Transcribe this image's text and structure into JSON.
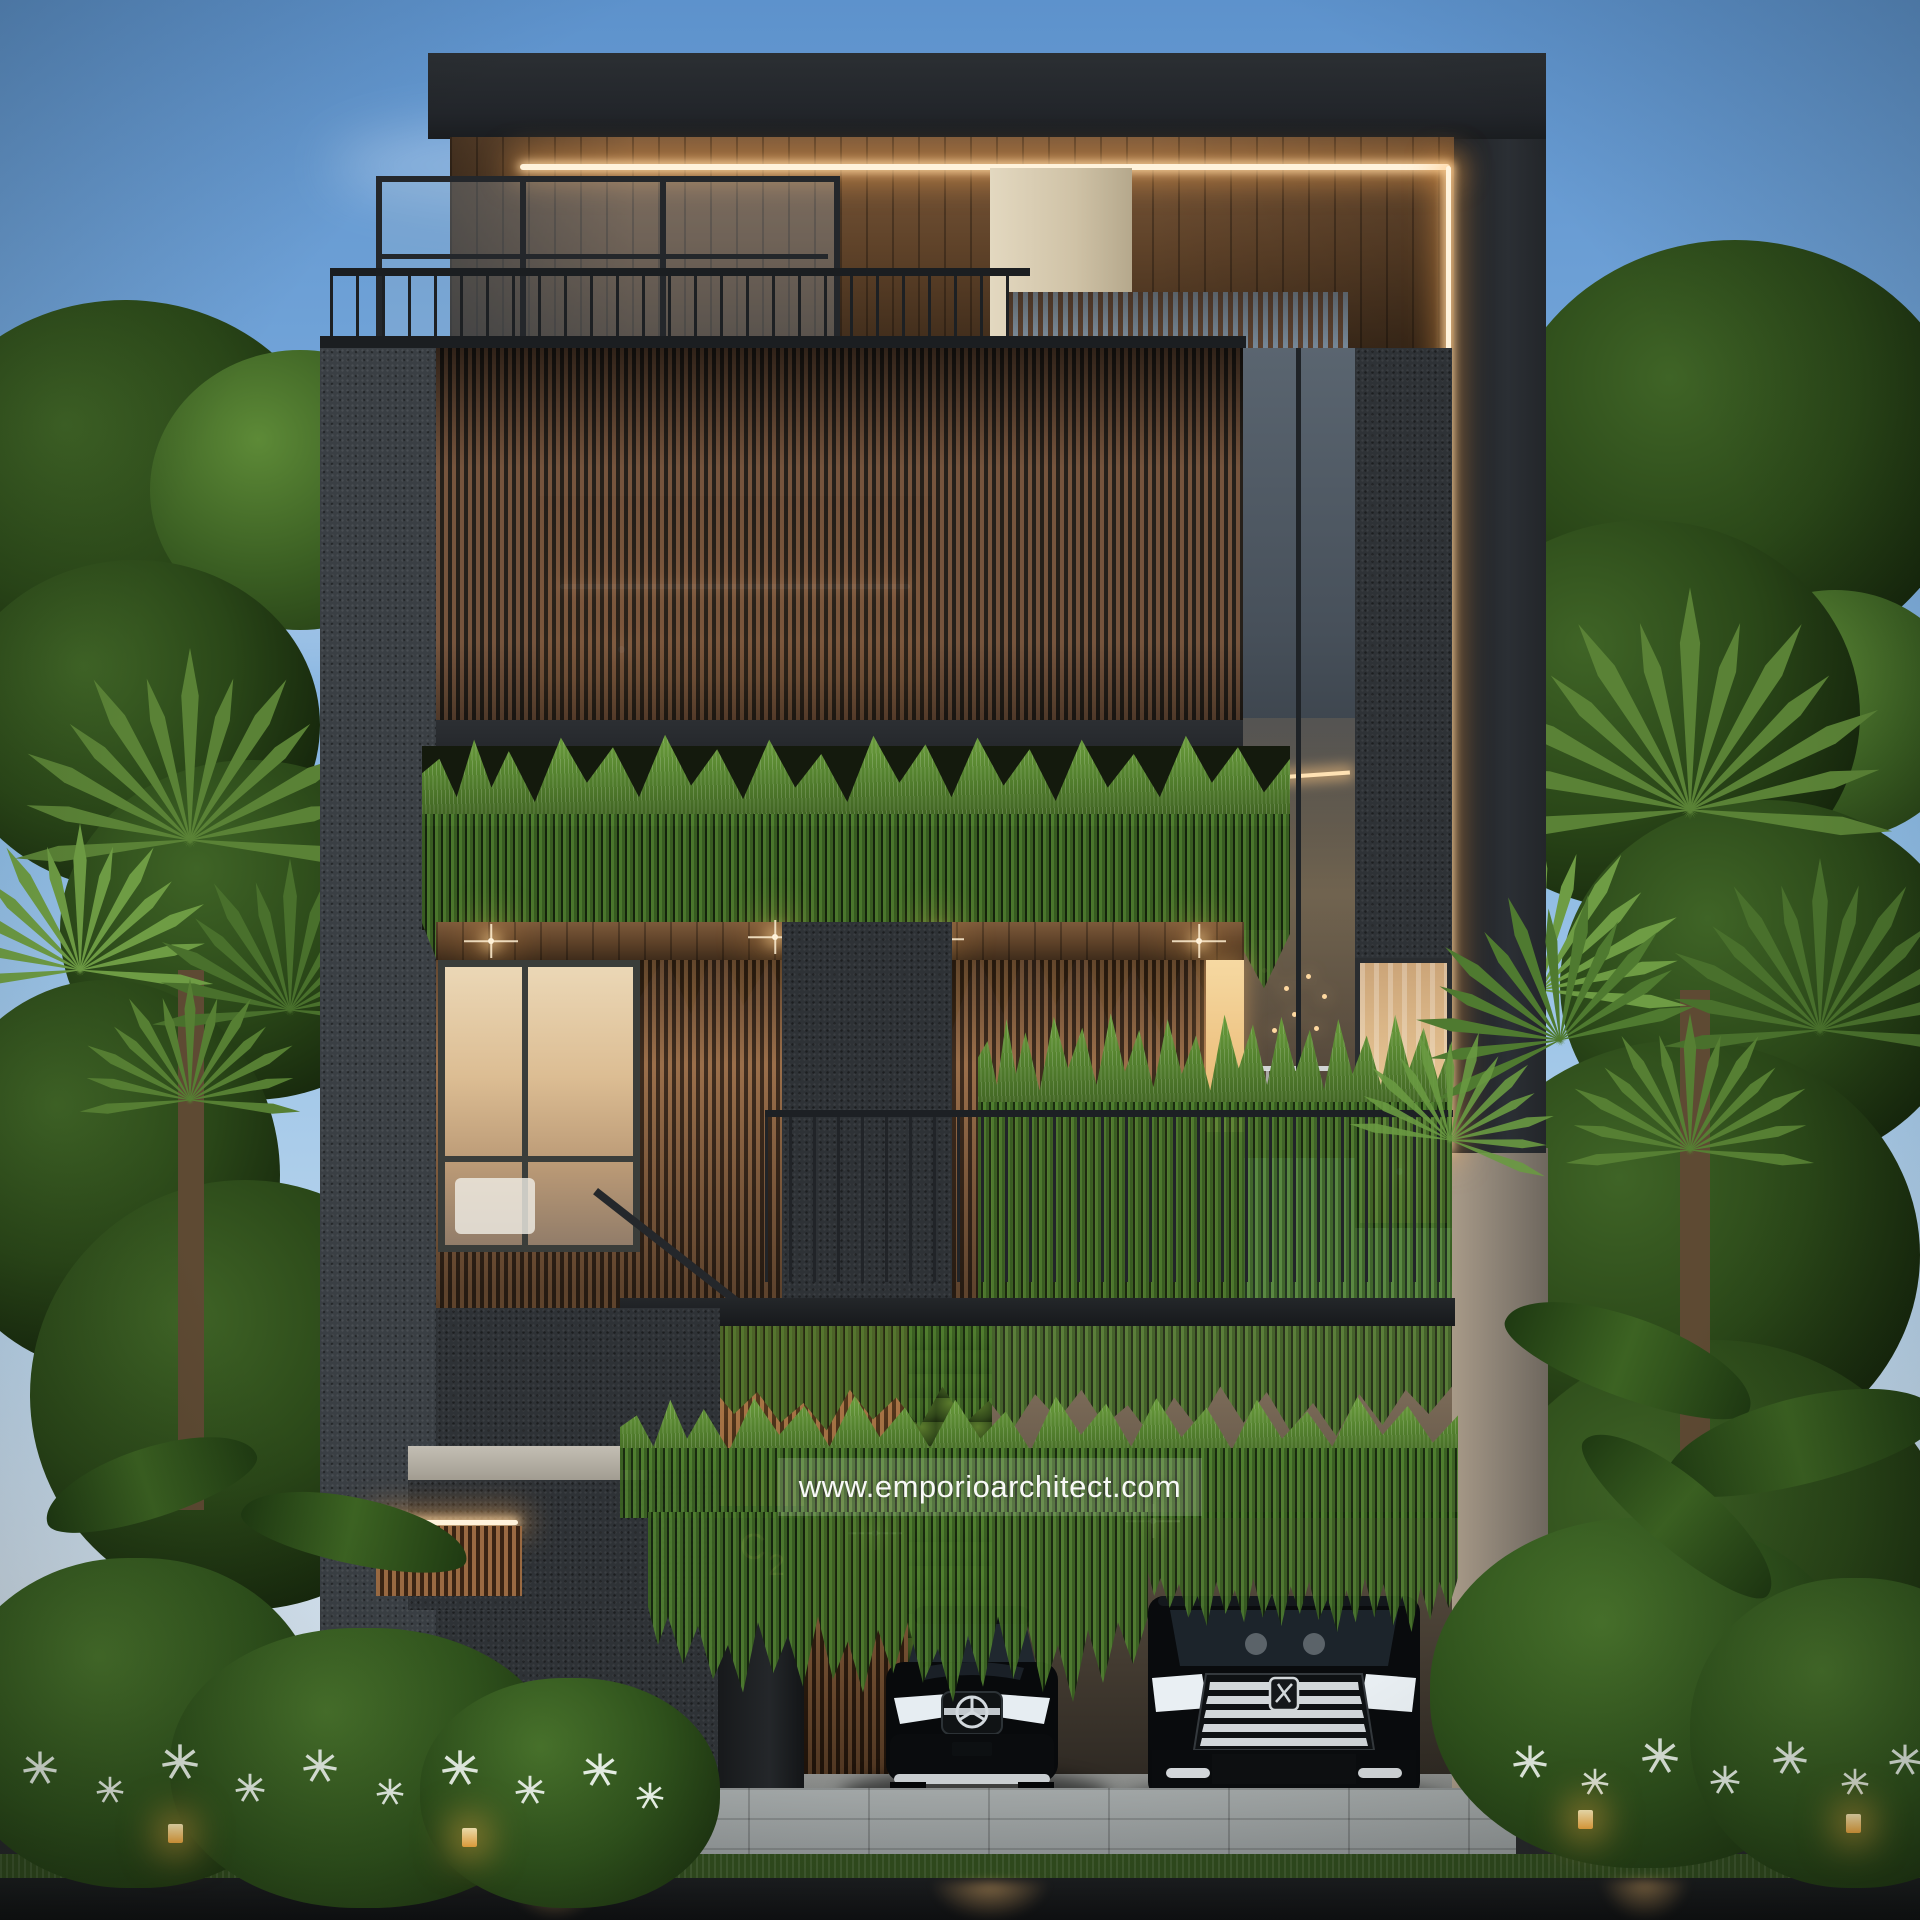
{
  "scene": {
    "title": "Modern tropical three-storey house exterior 3D render at dusk",
    "watermark_text": "www.emporioarchitect.com",
    "house_number": {
      "letter": "C",
      "digit": "2"
    }
  },
  "vehicles": {
    "left": "black luxury sedan with three-pointed-star grille emblem",
    "right": "black luxury MPV with large chrome grille"
  },
  "lighting": {
    "led_strips": "warm white LED strips under roof canopy and along right facade edge",
    "downlights": "warm soffit downlights",
    "garden_lights": "warm cube path lights in planting beds"
  },
  "palette": {
    "sky_top": "#5d92cc",
    "sky_horizon": "#e3ecf4",
    "foliage_dark": "#16270c",
    "foliage_mid": "#2f5220",
    "foliage_light": "#6fa23f",
    "wood_slat": "#7b573e",
    "wood_soffit": "#7d5a3b",
    "charcoal_fascia": "#25282c",
    "stone_gray": "#3a3f44",
    "cream_stone": "#d6c9ae",
    "led_warm": "#ffd9a4",
    "sunset_glass": "#e6cda4",
    "hedge_green": "#55832f",
    "gold_number": "#c9a05a",
    "paver_gray": "#9aa0a0",
    "road_dark": "#141517"
  }
}
